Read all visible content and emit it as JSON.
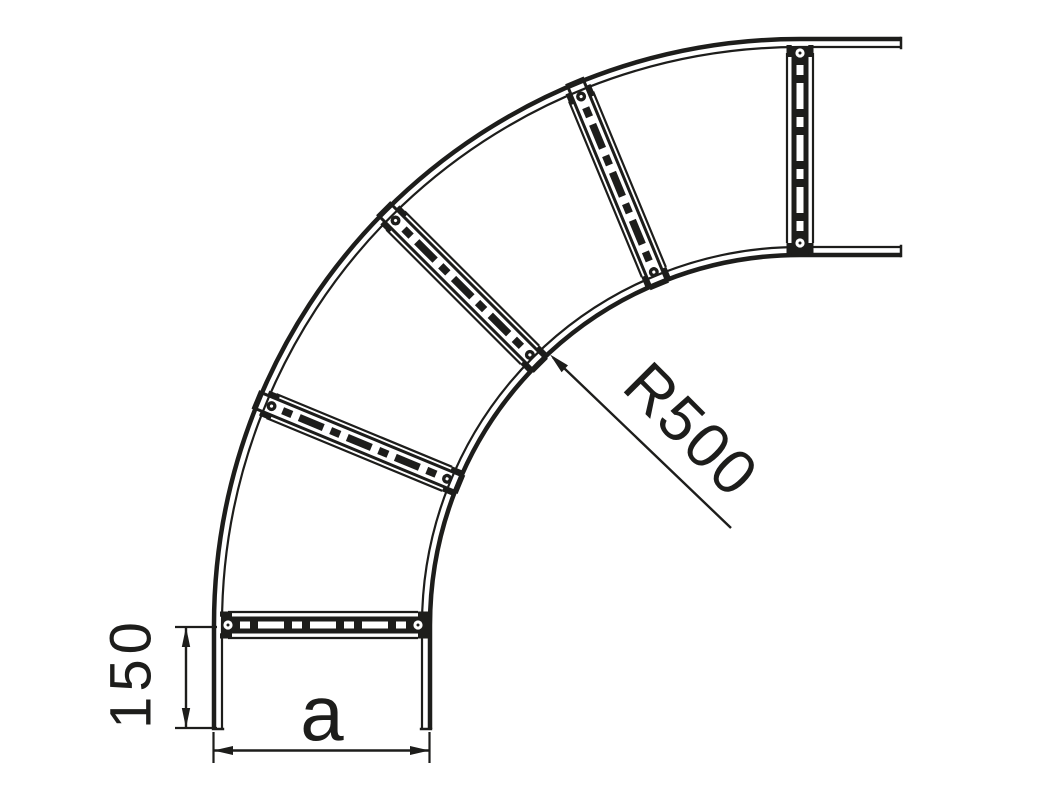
{
  "page": {
    "background": "#ffffff",
    "line_color": "#1d1d1b"
  },
  "diagram": {
    "kind": "technical-drawing",
    "subject": "cable-ladder-90-degree-bend",
    "bend_angle_deg": 90,
    "rung_count": 5,
    "dimensions": {
      "inner_radius": "R500",
      "tangent_length": "150",
      "width": "a"
    }
  }
}
